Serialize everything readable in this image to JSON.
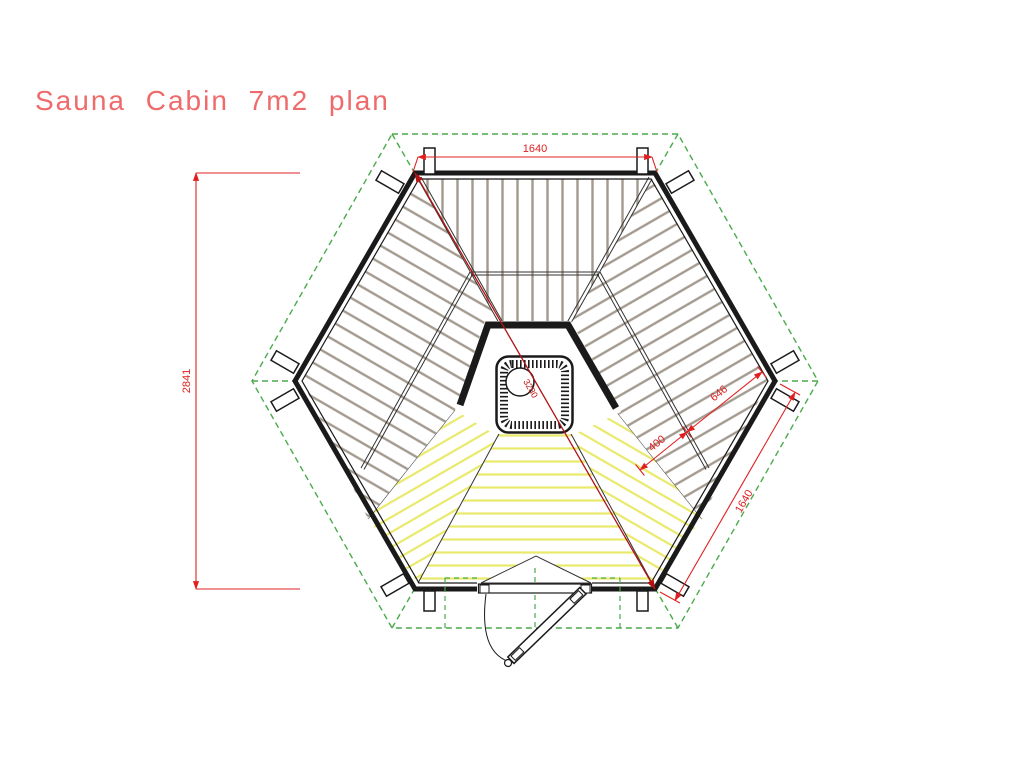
{
  "title": "Sauna Cabin 7m2 plan",
  "dimensions": {
    "width_top": "1640",
    "height_left": "2841",
    "diagonal": "3280",
    "bench_depth": "646",
    "step_depth": "400",
    "wall_side": "1640"
  },
  "colors": {
    "dimension_red": "#e02020",
    "diagonal_red": "#b31212",
    "title_red": "#ef6a6a",
    "roof_green": "#4aaa4a",
    "floor_yellow": "#e9e96b",
    "bench_plank_grey": "#a39a8f",
    "wall_black": "#1a1a1a"
  }
}
